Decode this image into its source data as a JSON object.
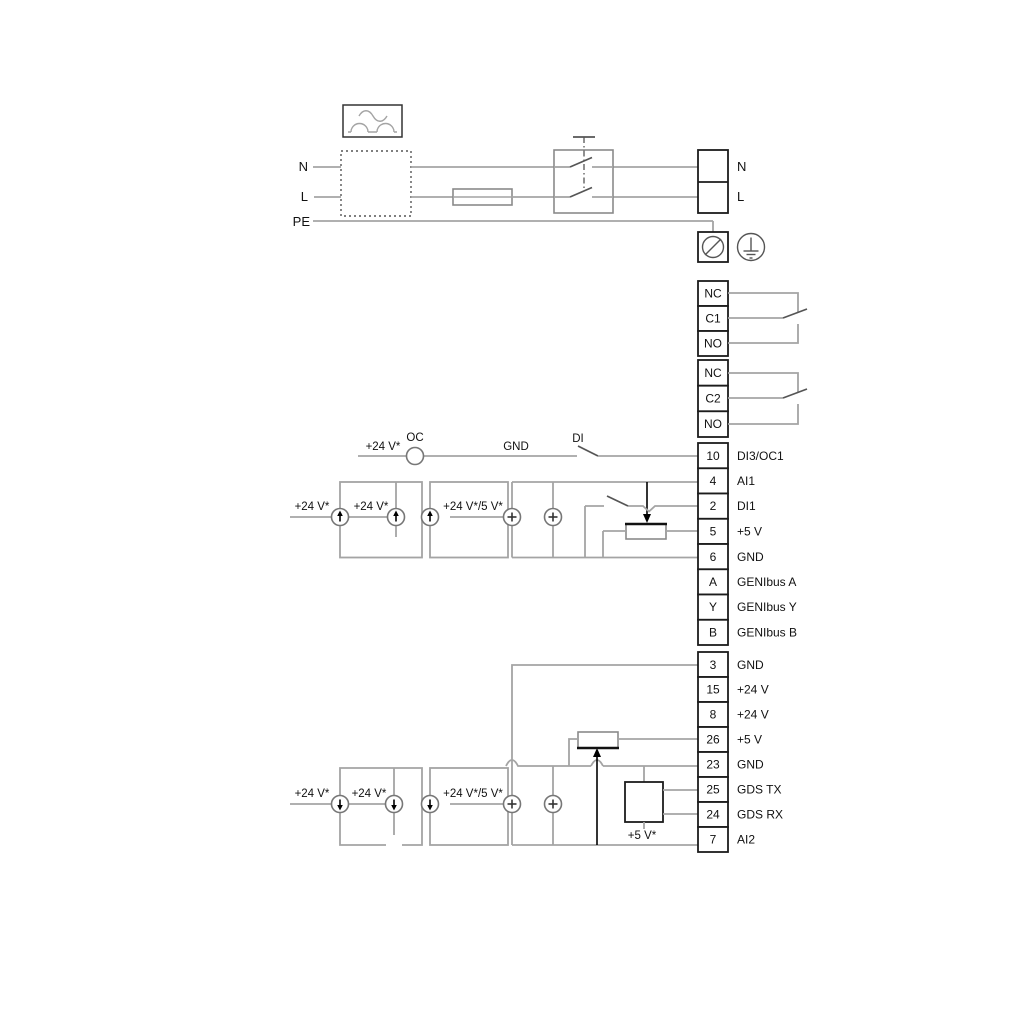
{
  "diagram": {
    "title_hint": "pump wiring diagram",
    "colors": {
      "wire": "#a4a4a4",
      "outline": "#1c1c1c",
      "text": "#111111",
      "background": "#ffffff"
    },
    "power": {
      "n_left": "N",
      "l_left": "L",
      "pe": "PE",
      "n_right": "N",
      "l_right": "L"
    },
    "relay1": {
      "nc": "NC",
      "com": "C1",
      "no": "NO"
    },
    "relay2": {
      "nc": "NC",
      "com": "C2",
      "no": "NO"
    },
    "io_terminals": [
      {
        "pin": "10",
        "label": "DI3/OC1"
      },
      {
        "pin": "4",
        "label": "AI1"
      },
      {
        "pin": "2",
        "label": "DI1"
      },
      {
        "pin": "5",
        "label": "+5 V"
      },
      {
        "pin": "6",
        "label": "GND"
      },
      {
        "pin": "A",
        "label": "GENIbus A"
      },
      {
        "pin": "Y",
        "label": "GENIbus Y"
      },
      {
        "pin": "B",
        "label": "GENIbus B"
      }
    ],
    "aux_terminals": [
      {
        "pin": "3",
        "label": "GND"
      },
      {
        "pin": "15",
        "label": "+24 V"
      },
      {
        "pin": "8",
        "label": "+24 V"
      },
      {
        "pin": "26",
        "label": "+5 V"
      },
      {
        "pin": "23",
        "label": "GND"
      },
      {
        "pin": "25",
        "label": "GDS TX"
      },
      {
        "pin": "24",
        "label": "GDS RX"
      },
      {
        "pin": "7",
        "label": "AI2"
      }
    ],
    "annotations": {
      "oc_supply": "+24 V*",
      "oc": "OC",
      "gnd": "GND",
      "di": "DI",
      "u_supply1": "+24 V*",
      "u_supply2": "+24 V*",
      "u_supply3": "+24 V*/5 V*",
      "l_supply1": "+24 V*",
      "l_supply2": "+24 V*",
      "l_supply3": "+24 V*/5 V*",
      "gds_pullup": "+5 V*"
    }
  }
}
